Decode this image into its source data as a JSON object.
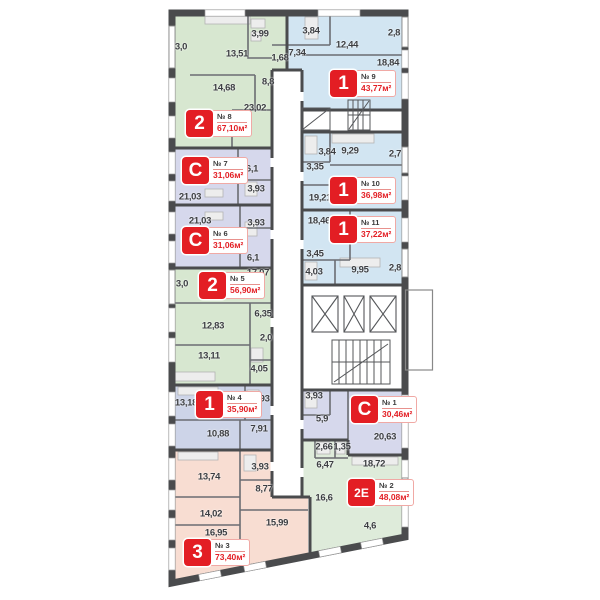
{
  "plan": {
    "background": "#ffffff",
    "wall_color": "#4a4b4d",
    "thin_wall_color": "#6b6d72",
    "badge_red": "#e31e24",
    "area_unit": "м²",
    "type_colors": {
      "1": "#d2e5f2",
      "2": "#d7e7d0",
      "3": "#f8ddd2",
      "C": "#d6d8ec",
      "2E": "#deebda"
    },
    "apartments": [
      {
        "id": "8",
        "type": "2",
        "number": "№ 8",
        "area": "67,10м²",
        "badge": {
          "x": 186,
          "y": 110
        },
        "rooms": [
          {
            "t": "3,0",
            "x": 181,
            "y": 47
          },
          {
            "t": "13,51",
            "x": 237,
            "y": 54
          },
          {
            "t": "3,99",
            "x": 260,
            "y": 34
          },
          {
            "t": "1,68",
            "x": 280,
            "y": 58
          },
          {
            "t": "14,68",
            "x": 224,
            "y": 88
          },
          {
            "t": "8,8",
            "x": 268,
            "y": 82
          },
          {
            "t": "23,02",
            "x": 255,
            "y": 108
          }
        ]
      },
      {
        "id": "9",
        "type": "1",
        "number": "№ 9",
        "area": "43,77м²",
        "badge": {
          "x": 330,
          "y": 70
        },
        "rooms": [
          {
            "t": "3,84",
            "x": 311,
            "y": 31
          },
          {
            "t": "12,44",
            "x": 347,
            "y": 45
          },
          {
            "t": "2,8",
            "x": 394,
            "y": 33
          },
          {
            "t": "7,34",
            "x": 297,
            "y": 53
          },
          {
            "t": "18,84",
            "x": 388,
            "y": 63
          }
        ]
      },
      {
        "id": "7",
        "type": "C",
        "number": "№ 7",
        "area": "31,06м²",
        "badge": {
          "x": 182,
          "y": 157
        },
        "rooms": [
          {
            "t": "6,1",
            "x": 252,
            "y": 169
          },
          {
            "t": "3,93",
            "x": 256,
            "y": 189
          },
          {
            "t": "21,03",
            "x": 190,
            "y": 197
          }
        ]
      },
      {
        "id": "10",
        "type": "1",
        "number": "№ 10",
        "area": "36,98м²",
        "badge": {
          "x": 330,
          "y": 177
        },
        "rooms": [
          {
            "t": "3,84",
            "x": 327,
            "y": 152
          },
          {
            "t": "9,29",
            "x": 350,
            "y": 151
          },
          {
            "t": "2,7",
            "x": 395,
            "y": 154
          },
          {
            "t": "3,35",
            "x": 315,
            "y": 167
          },
          {
            "t": "19,21",
            "x": 320,
            "y": 198
          }
        ]
      },
      {
        "id": "6",
        "type": "C",
        "number": "№ 6",
        "area": "31,06м²",
        "badge": {
          "x": 182,
          "y": 227
        },
        "rooms": [
          {
            "t": "21,03",
            "x": 200,
            "y": 221
          },
          {
            "t": "3,93",
            "x": 256,
            "y": 223
          },
          {
            "t": "6,1",
            "x": 253,
            "y": 258
          }
        ]
      },
      {
        "id": "11",
        "type": "1",
        "number": "№ 11",
        "area": "37,22м²",
        "badge": {
          "x": 330,
          "y": 216
        },
        "rooms": [
          {
            "t": "18,46",
            "x": 319,
            "y": 221
          },
          {
            "t": "3,45",
            "x": 315,
            "y": 254
          },
          {
            "t": "4,03",
            "x": 314,
            "y": 272
          },
          {
            "t": "9,95",
            "x": 360,
            "y": 270
          },
          {
            "t": "2,8",
            "x": 395,
            "y": 268
          }
        ]
      },
      {
        "id": "5",
        "type": "2",
        "number": "№ 5",
        "area": "56,90м²",
        "badge": {
          "x": 199,
          "y": 272
        },
        "rooms": [
          {
            "t": "3,0",
            "x": 182,
            "y": 284
          },
          {
            "t": "17,07",
            "x": 258,
            "y": 273
          },
          {
            "t": "6,35",
            "x": 263,
            "y": 314
          },
          {
            "t": "12,83",
            "x": 213,
            "y": 326
          },
          {
            "t": "2,0",
            "x": 266,
            "y": 338
          },
          {
            "t": "13,11",
            "x": 209,
            "y": 356
          },
          {
            "t": "4,05",
            "x": 259,
            "y": 369
          }
        ]
      },
      {
        "id": "4",
        "type": "1",
        "color": "#cdd4e8",
        "number": "№ 4",
        "area": "35,90м²",
        "badge": {
          "x": 196,
          "y": 391
        },
        "rooms": [
          {
            "t": "13,18",
            "x": 186,
            "y": 403
          },
          {
            "t": "3,93",
            "x": 261,
            "y": 399
          },
          {
            "t": "10,88",
            "x": 218,
            "y": 434
          },
          {
            "t": "7,91",
            "x": 259,
            "y": 429
          }
        ]
      },
      {
        "id": "1",
        "type": "C",
        "number": "№ 1",
        "area": "30,46м²",
        "badge": {
          "x": 351,
          "y": 396
        },
        "rooms": [
          {
            "t": "3,93",
            "x": 314,
            "y": 396
          },
          {
            "t": "5,9",
            "x": 322,
            "y": 419
          },
          {
            "t": "20,63",
            "x": 385,
            "y": 437
          }
        ]
      },
      {
        "id": "2",
        "type": "2E",
        "number": "№ 2",
        "area": "48,08м²",
        "badge": {
          "x": 348,
          "y": 479
        },
        "rooms": [
          {
            "t": "2,66",
            "x": 324,
            "y": 447
          },
          {
            "t": "1,35",
            "x": 342,
            "y": 447
          },
          {
            "t": "6,47",
            "x": 325,
            "y": 465
          },
          {
            "t": "18,72",
            "x": 374,
            "y": 464
          },
          {
            "t": "16,6",
            "x": 324,
            "y": 498
          },
          {
            "t": "4,6",
            "x": 370,
            "y": 526
          }
        ]
      },
      {
        "id": "3",
        "type": "3",
        "number": "№ 3",
        "area": "73,40м²",
        "badge": {
          "x": 184,
          "y": 539
        },
        "rooms": [
          {
            "t": "13,74",
            "x": 209,
            "y": 477
          },
          {
            "t": "3,93",
            "x": 260,
            "y": 467
          },
          {
            "t": "8,77",
            "x": 264,
            "y": 489
          },
          {
            "t": "14,02",
            "x": 211,
            "y": 514
          },
          {
            "t": "15,99",
            "x": 277,
            "y": 523
          },
          {
            "t": "16,95",
            "x": 216,
            "y": 533
          }
        ]
      }
    ]
  }
}
